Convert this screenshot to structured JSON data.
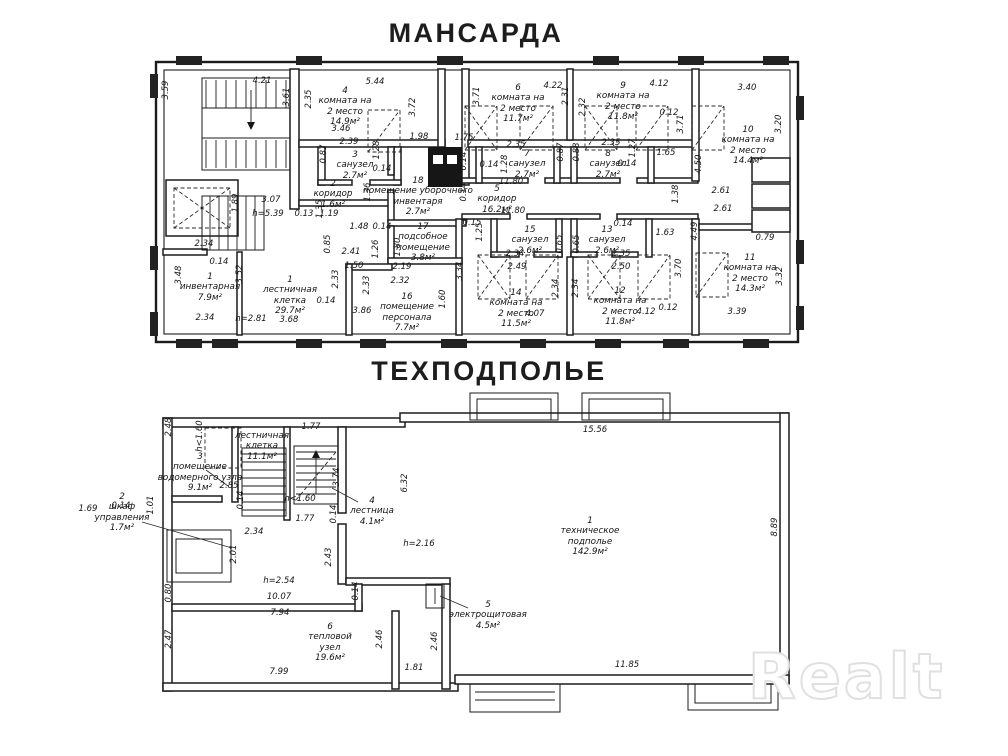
{
  "titles": {
    "top": "МАНСАРДА",
    "bottom": "ТЕХПОДПОЛЬЕ"
  },
  "watermark": {
    "text": "Realt"
  },
  "colors": {
    "ink": "#1b1b1b",
    "watermark_outline": "#e0e0e0",
    "background": "#ffffff"
  },
  "mansarda": {
    "rooms": [
      {
        "num": "4",
        "name": "комната на\n2 место",
        "area": "14.9м²"
      },
      {
        "num": "6",
        "name": "комната на\n2 место",
        "area": "11.7м²"
      },
      {
        "num": "9",
        "name": "комната на\n2 место",
        "area": "11.8м²"
      },
      {
        "num": "10",
        "name": "комната на\n2 место",
        "area": "14.4м²"
      },
      {
        "num": "11",
        "name": "комната на\n2 место",
        "area": "14.3м²"
      },
      {
        "num": "12",
        "name": "комната на\n2 место",
        "area": "11.8м²"
      },
      {
        "num": "14",
        "name": "комната на\n2 место",
        "area": "11.5м²"
      },
      {
        "num": "3",
        "name": "санузел",
        "area": "2.7м²"
      },
      {
        "num": "7",
        "name": "санузел",
        "area": "2.7м²"
      },
      {
        "num": "8",
        "name": "санузел",
        "area": "2.7м²"
      },
      {
        "num": "15",
        "name": "санузел",
        "area": "2.6м²"
      },
      {
        "num": "13",
        "name": "санузел",
        "area": "2.6м²"
      },
      {
        "num": "2",
        "name": "коридор",
        "area": "1.6м²"
      },
      {
        "num": "5",
        "name": "коридор",
        "area": "16.2м²"
      },
      {
        "num": "18",
        "name": "помещение уборочного\nинвентаря",
        "area": "2.7м²"
      },
      {
        "num": "17",
        "name": "подсобное\nпомещение",
        "area": "3.8м²"
      },
      {
        "num": "16",
        "name": "помещение\nперсонала",
        "area": "7.7м²"
      },
      {
        "num": "1",
        "name": "инвентарная",
        "area": "7.9м²"
      },
      {
        "num": "1",
        "name": "лестничная\nклетка",
        "area": "29.7м²"
      }
    ],
    "dims": [
      "4.21",
      "5.44",
      "4.22",
      "4.12",
      "3.40",
      "3.59",
      "3.61",
      "2.35",
      "3.72",
      "1.98",
      "3.71",
      "2.31",
      "2.32",
      "3.71",
      "3.20",
      "0.12",
      "1.75",
      "3.46",
      "2.39",
      "0.87",
      "1.28",
      "0.14",
      "2.35",
      "1.28",
      "0.87",
      "0.88",
      "2.35",
      "1.27",
      "0.14",
      "1.65",
      "0.14",
      "4.50",
      "1.38",
      "2.61",
      "2.61",
      "0.79",
      "4.49",
      "1.63",
      "3.70",
      "3.32",
      "3.39",
      "0.12",
      "4.12",
      "11.80",
      "11.80",
      "0.14",
      "0.14",
      "0.15",
      "1.25",
      "0.14",
      "2.34",
      "2.49",
      "2.35",
      "2.50",
      "0.65",
      "0.65",
      "3.34",
      "2.34",
      "2.34",
      "4.07",
      "1.60",
      "1.80",
      "1.26",
      "1.48",
      "0.14",
      "0.85",
      "2.41",
      "1.50",
      "2.19",
      "2.32",
      "2.33",
      "2.33",
      "0.14",
      "3.86",
      "3.68",
      "h=2.81",
      "2.34",
      "3.52",
      "3.48",
      "0.14",
      "2.34",
      "1.89",
      "3.07",
      "h=5.39",
      "0.13",
      "1.35",
      "1.19",
      "1.36"
    ]
  },
  "tehpodpolye": {
    "rooms": [
      {
        "num": "1",
        "name": "техническое\nподполье",
        "area": "142.9м²"
      },
      {
        "num": "",
        "name": "лестничная\nклетка",
        "area": "11.1м²"
      },
      {
        "num": "3",
        "name": "помещение\nводомерного узла",
        "area": "9.1м²"
      },
      {
        "num": "4",
        "name": "лестница",
        "area": "4.1м²"
      },
      {
        "num": "5",
        "name": "электрощитовая",
        "area": "4.5м²"
      },
      {
        "num": "6",
        "name": "тепловой\nузел",
        "area": "19.6м²"
      },
      {
        "num": "2",
        "name": "шкаф\nуправления",
        "area": "1.7м²"
      }
    ],
    "dims": [
      "15.56",
      "8.89",
      "11.85",
      "2.48",
      "h<1.60",
      "1.77",
      "2.85",
      "1.01",
      "1.69",
      "0.14",
      "0.14",
      "3.74",
      "0.14",
      "1.77",
      "h<1.60",
      "6.32",
      "2.43",
      "h=2.16",
      "2.34",
      "2.01",
      "0.80",
      "h=2.54",
      "10.07",
      "7.94",
      "0.14",
      "2.47",
      "7.99",
      "2.46",
      "2.46",
      "1.81"
    ]
  }
}
